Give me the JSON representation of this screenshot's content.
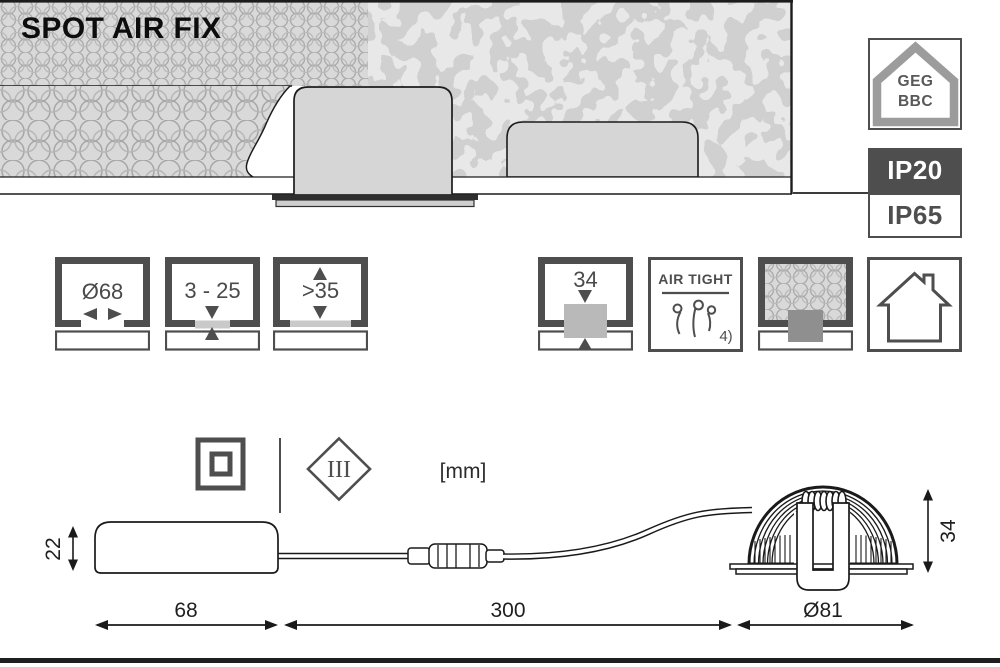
{
  "title": "SPOT AIR FIX",
  "units_label": "[mm]",
  "badges": {
    "geg": {
      "line1": "GEG",
      "line2": "BBC"
    },
    "ip_primary": "IP20",
    "ip_secondary": "IP65"
  },
  "feature_icons": [
    {
      "id": "cutout-diameter",
      "label": "Ø68"
    },
    {
      "id": "ceiling-thickness",
      "label": "3 - 25"
    },
    {
      "id": "min-recess-clearance",
      "label": ">35"
    },
    {
      "id": "recess-depth",
      "label": "34"
    },
    {
      "id": "air-tight",
      "label": "AIR TIGHT",
      "footnote": "4)"
    },
    {
      "id": "insulation-coverable",
      "label": ""
    },
    {
      "id": "indoor-use",
      "label": ""
    }
  ],
  "symbols": {
    "protection_class": "III"
  },
  "dimensions": {
    "driver_height": "22",
    "driver_length": "68",
    "cable_length": "300",
    "spot_diameter": "Ø81",
    "spot_height": "34"
  },
  "colors": {
    "line_dark": "#1c1c1c",
    "icon_border": "#4e4e4e",
    "badge_dark_bg": "#4e4e4e",
    "insulation_fill": "#d9d9d9",
    "insulation_stroke": "#a6a6a6",
    "metal_fill": "#d6d6d6",
    "trim_dark": "#2f2f2f"
  }
}
